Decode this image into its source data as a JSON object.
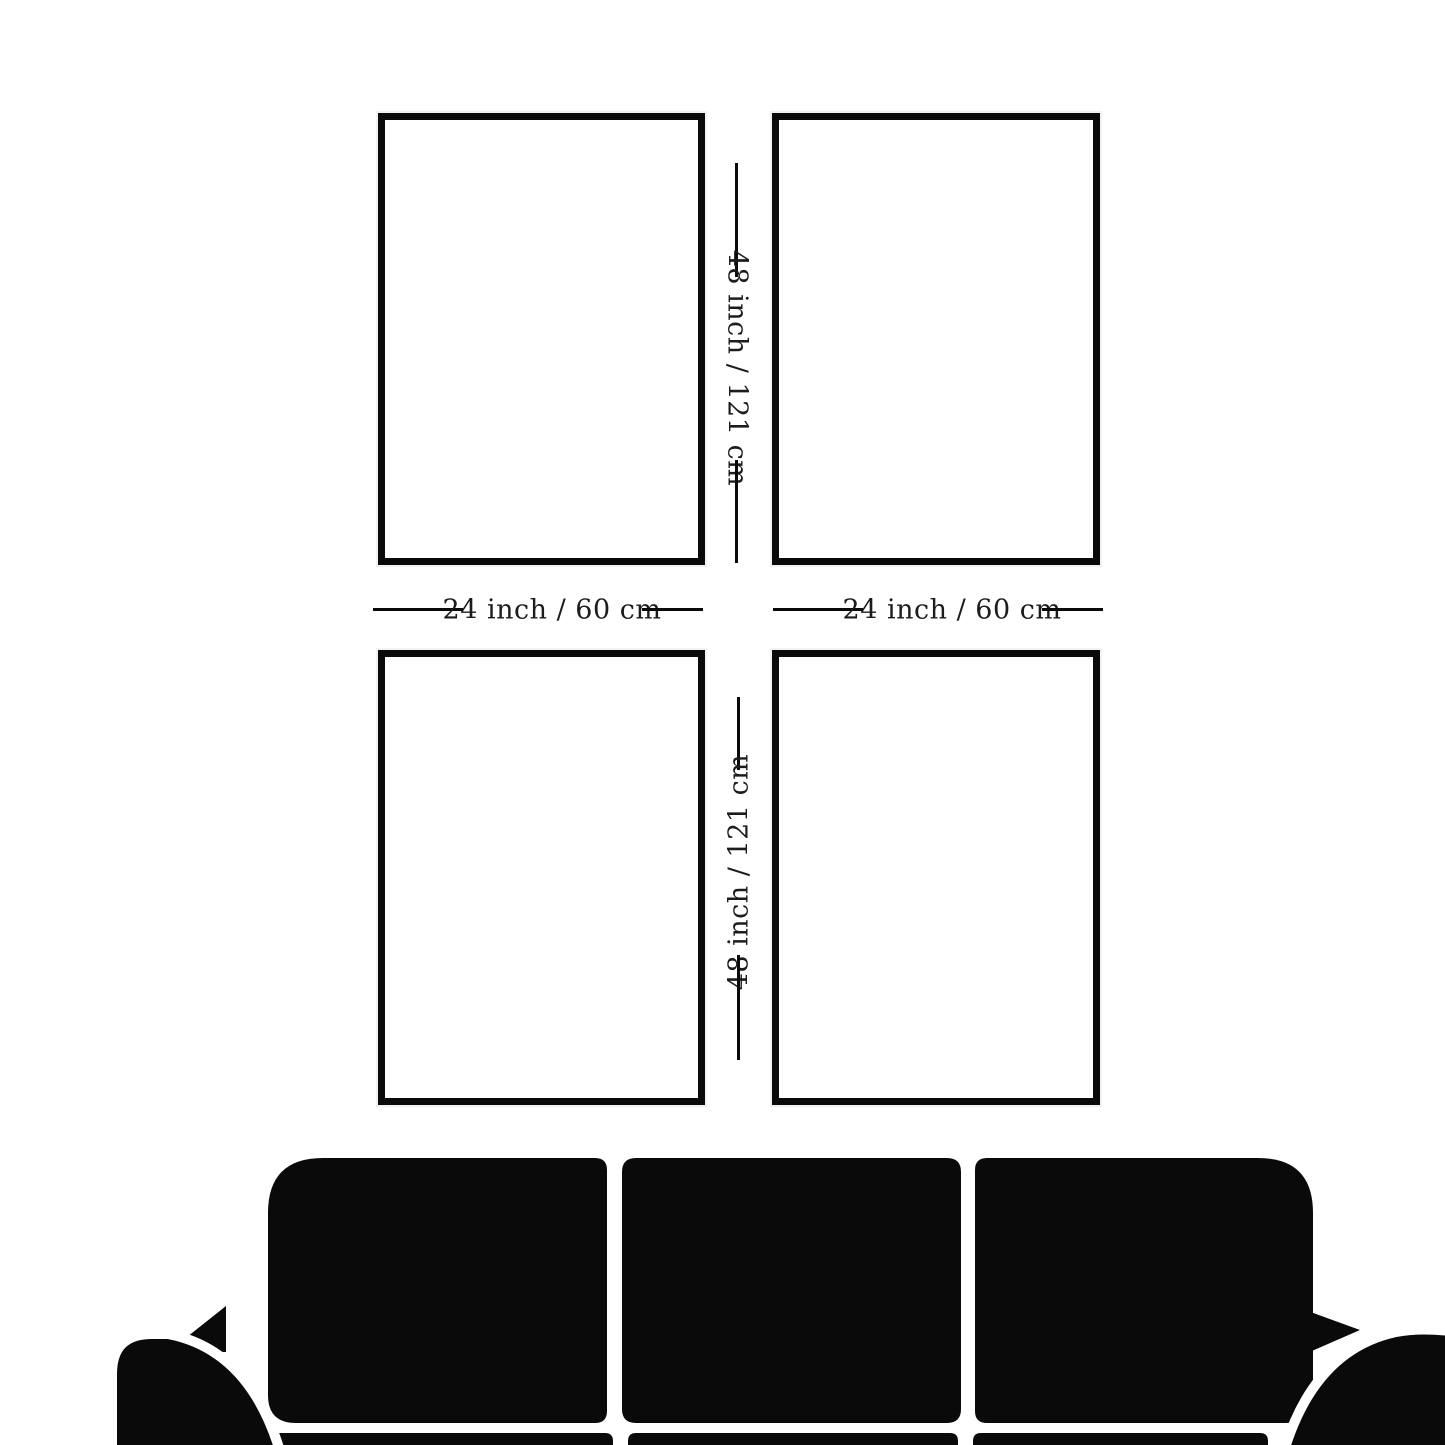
{
  "colors": {
    "background": "#ffffff",
    "ink": "#0a0a0b",
    "text": "#1c1c1c"
  },
  "size_guide": {
    "title": "wall-art-size-guide",
    "frames": [
      {
        "id": "top-left"
      },
      {
        "id": "top-right"
      },
      {
        "id": "bottom-left"
      },
      {
        "id": "bottom-right"
      }
    ],
    "labels": {
      "top_height": "48 inch / 121 cm",
      "bottom_height": "48 inch / 121 cm",
      "left_width": "24 inch / 60 cm",
      "right_width": "24 inch / 60 cm"
    },
    "furniture": "sofa-silhouette"
  }
}
